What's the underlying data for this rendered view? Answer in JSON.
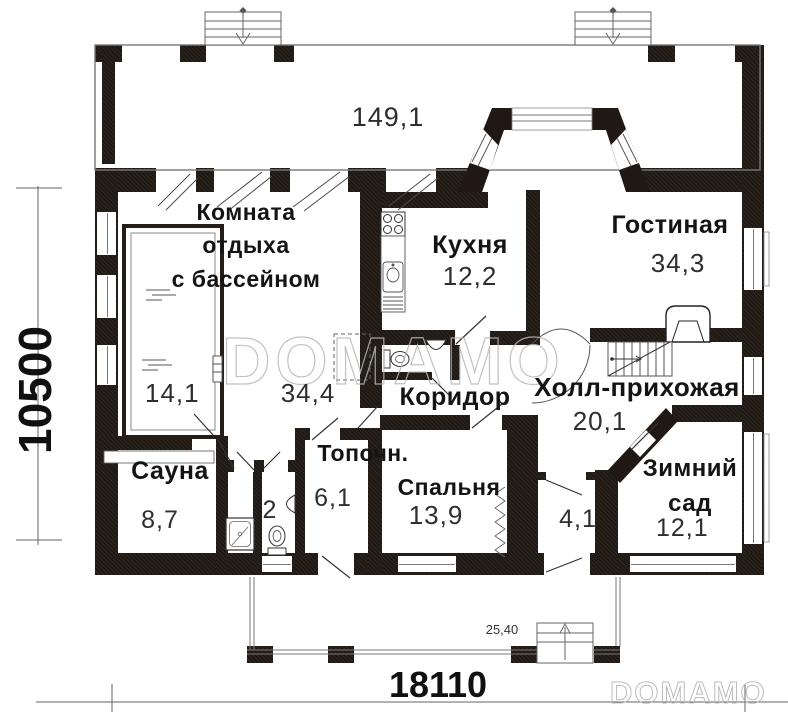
{
  "plan": {
    "rooms": {
      "terrace": {
        "area": "149,1"
      },
      "rest_room": {
        "label": "Комната отдыха с бассейном",
        "area": "34,4",
        "pool_area": "14,1"
      },
      "kitchen": {
        "label": "Кухня",
        "area": "12,2"
      },
      "living_room": {
        "label": "Гостиная",
        "area": "34,3"
      },
      "hall": {
        "label": "Холл-прихожая",
        "area": "20,1"
      },
      "corridor": {
        "label": "Коридор"
      },
      "sauna": {
        "label": "Сауна",
        "area": "8,7"
      },
      "wc": {
        "area": "2"
      },
      "boiler_room": {
        "label": "Топочн.",
        "area": "6,1"
      },
      "bedroom": {
        "label": "Спальня",
        "area": "13,9"
      },
      "tambour": {
        "area": "4,1"
      },
      "winter_garden": {
        "label": "Зимний сад",
        "area": "12,1"
      }
    },
    "dimensions": {
      "height_total": "10500",
      "width_total": "18110",
      "porch": "25,40"
    },
    "watermark": {
      "center": "DOMAMO",
      "corner": "DOMAMO"
    },
    "colors": {
      "wall": "#1f1813",
      "paper": "#ffffff",
      "line": "#666666",
      "watermark_stroke": "#b8b8b8"
    },
    "fixtures": [
      "stove",
      "kitchen-sink",
      "toilet",
      "washbasin",
      "shower-tray",
      "fireplace",
      "interior-stairs",
      "entrance-stairs",
      "porch-steps",
      "pool",
      "pool-ladder",
      "sauna-bench"
    ]
  }
}
